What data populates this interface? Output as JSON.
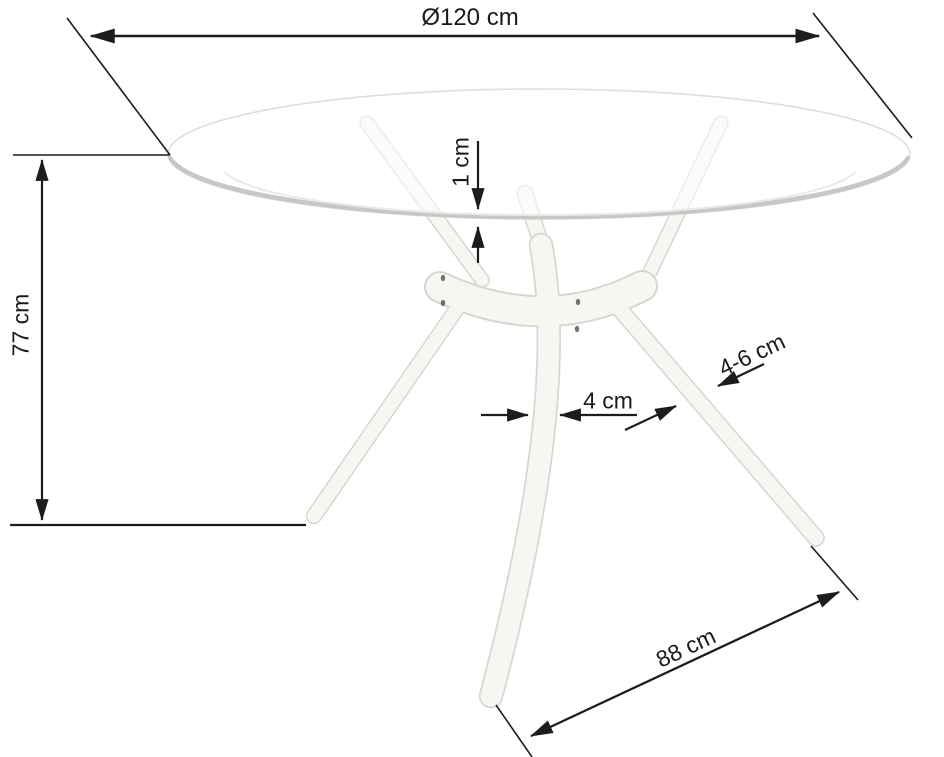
{
  "drawing": {
    "subject": "round-glass-table-dimension-diagram",
    "dimension_labels": {
      "diameter": "Ø120 cm",
      "height": "77 cm",
      "glass_thickness": "1 cm",
      "leg_width": "4 cm",
      "leg_section": "4-6 cm",
      "leg_length": "88 cm"
    },
    "colors": {
      "dimension_line": "#1c1c1c",
      "label_text": "#1b1b1b",
      "background": "#ffffff",
      "wood_body": "#f7f6f3",
      "wood_edge": "#d9d6d1",
      "glass_rim": "#c7c7c5",
      "glass_outline": "#dedede",
      "screw_dot": "#73716d"
    }
  }
}
